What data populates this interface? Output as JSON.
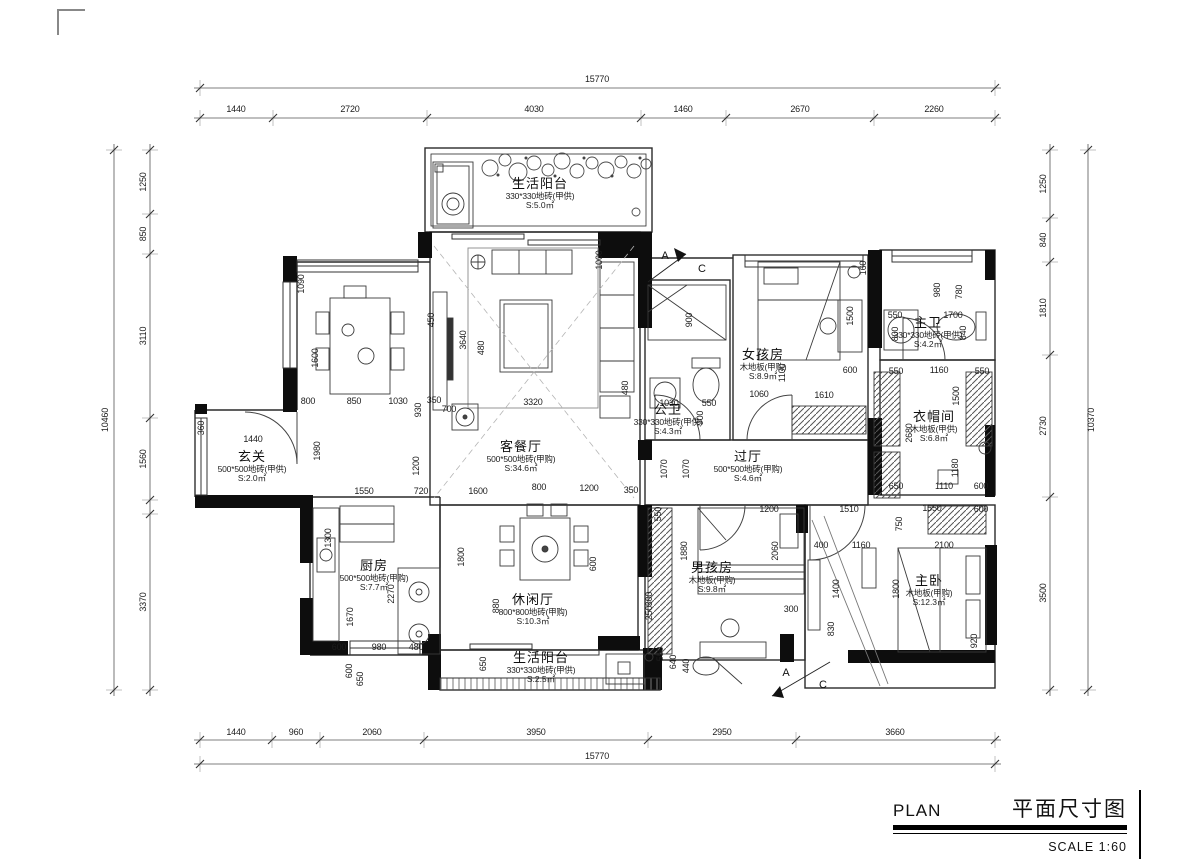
{
  "title_block": {
    "plan_en": "PLAN",
    "plan_zh": "平面尺寸图",
    "scale": "SCALE 1:60"
  },
  "plan": {
    "rooms": [
      {
        "name": "生活阳台",
        "spec": "330*330地砖(甲供)",
        "area": "S:5.0㎡",
        "x": 540,
        "y": 188
      },
      {
        "name": "玄关",
        "spec": "500*500地砖(甲供)",
        "area": "S:2.0㎡",
        "x": 252,
        "y": 461
      },
      {
        "name": "客餐厅",
        "spec": "500*500地砖(甲购)",
        "area": "S:34.6㎡",
        "x": 521,
        "y": 451
      },
      {
        "name": "公卫",
        "spec": "330*330地砖(甲供)",
        "area": "S:4.3㎡",
        "x": 668,
        "y": 414
      },
      {
        "name": "女孩房",
        "spec": "木地板(甲购)",
        "area": "S:8.9㎡",
        "x": 763,
        "y": 359
      },
      {
        "name": "主卫",
        "spec": "330*330地砖(甲供)",
        "area": "S:4.2㎡",
        "x": 928,
        "y": 327
      },
      {
        "name": "衣帽间",
        "spec": "木地板(甲供)",
        "area": "S:6.8㎡",
        "x": 934,
        "y": 421
      },
      {
        "name": "过厅",
        "spec": "500*500地砖(甲购)",
        "area": "S:4.6㎡",
        "x": 748,
        "y": 461
      },
      {
        "name": "厨房",
        "spec": "500*500地砖(甲购)",
        "area": "S:7.7㎡",
        "x": 374,
        "y": 570
      },
      {
        "name": "休闲厅",
        "spec": "800*800地砖(甲购)",
        "area": "S:10.3㎡",
        "x": 533,
        "y": 604
      },
      {
        "name": "男孩房",
        "spec": "木地板(甲购)",
        "area": "S:9.8㎡",
        "x": 712,
        "y": 572
      },
      {
        "name": "主卧",
        "spec": "木地板(甲购)",
        "area": "S:12.3㎡",
        "x": 929,
        "y": 585
      },
      {
        "name": "生活阳台",
        "spec": "330*330地砖(甲供)",
        "area": "S:2.5㎡",
        "x": 541,
        "y": 662
      }
    ],
    "dims": [
      {
        "t": "15770",
        "x": 597,
        "y": 82
      },
      {
        "t": "1440",
        "x": 236,
        "y": 112
      },
      {
        "t": "2720",
        "x": 350,
        "y": 112
      },
      {
        "t": "4030",
        "x": 534,
        "y": 112
      },
      {
        "t": "1460",
        "x": 683,
        "y": 112
      },
      {
        "t": "2670",
        "x": 800,
        "y": 112
      },
      {
        "t": "2260",
        "x": 934,
        "y": 112
      },
      {
        "t": "1440",
        "x": 236,
        "y": 735
      },
      {
        "t": "960",
        "x": 296,
        "y": 735
      },
      {
        "t": "2060",
        "x": 372,
        "y": 735
      },
      {
        "t": "3950",
        "x": 536,
        "y": 735
      },
      {
        "t": "2950",
        "x": 722,
        "y": 735
      },
      {
        "t": "3660",
        "x": 895,
        "y": 735
      },
      {
        "t": "15770",
        "x": 597,
        "y": 759
      },
      {
        "t": "10460",
        "x": 108,
        "y": 420,
        "r": 1
      },
      {
        "t": "1250",
        "x": 146,
        "y": 182,
        "r": 1
      },
      {
        "t": "850",
        "x": 146,
        "y": 234,
        "r": 1
      },
      {
        "t": "3110",
        "x": 146,
        "y": 336,
        "r": 1
      },
      {
        "t": "1560",
        "x": 146,
        "y": 459,
        "r": 1
      },
      {
        "t": "3370",
        "x": 146,
        "y": 602,
        "r": 1
      },
      {
        "t": "10370",
        "x": 1094,
        "y": 420,
        "r": 1
      },
      {
        "t": "1250",
        "x": 1046,
        "y": 184,
        "r": 1
      },
      {
        "t": "840",
        "x": 1046,
        "y": 240,
        "r": 1
      },
      {
        "t": "1810",
        "x": 1046,
        "y": 308,
        "r": 1
      },
      {
        "t": "2730",
        "x": 1046,
        "y": 426,
        "r": 1
      },
      {
        "t": "3500",
        "x": 1046,
        "y": 593,
        "r": 1
      },
      {
        "t": "1090",
        "x": 304,
        "y": 284,
        "r": 1
      },
      {
        "t": "1600",
        "x": 318,
        "y": 358,
        "r": 1
      },
      {
        "t": "450",
        "x": 434,
        "y": 320,
        "r": 1
      },
      {
        "t": "3640",
        "x": 466,
        "y": 340,
        "r": 1
      },
      {
        "t": "480",
        "x": 484,
        "y": 348,
        "r": 1
      },
      {
        "t": "1000",
        "x": 602,
        "y": 260,
        "r": 1
      },
      {
        "t": "900",
        "x": 692,
        "y": 320,
        "r": 1
      },
      {
        "t": "1500",
        "x": 853,
        "y": 316,
        "r": 1
      },
      {
        "t": "160",
        "x": 866,
        "y": 268,
        "r": 1
      },
      {
        "t": "980",
        "x": 940,
        "y": 290,
        "r": 1
      },
      {
        "t": "780",
        "x": 962,
        "y": 292,
        "r": 1
      },
      {
        "t": "550",
        "x": 895,
        "y": 318
      },
      {
        "t": "1700",
        "x": 953,
        "y": 318
      },
      {
        "t": "800",
        "x": 898,
        "y": 334,
        "r": 1
      },
      {
        "t": "840",
        "x": 966,
        "y": 333,
        "r": 1
      },
      {
        "t": "800",
        "x": 308,
        "y": 404
      },
      {
        "t": "850",
        "x": 354,
        "y": 404
      },
      {
        "t": "1030",
        "x": 398,
        "y": 404
      },
      {
        "t": "930",
        "x": 421,
        "y": 410,
        "r": 1
      },
      {
        "t": "350",
        "x": 434,
        "y": 403
      },
      {
        "t": "700",
        "x": 449,
        "y": 412
      },
      {
        "t": "3320",
        "x": 533,
        "y": 405
      },
      {
        "t": "1030",
        "x": 669,
        "y": 406
      },
      {
        "t": "550",
        "x": 709,
        "y": 406
      },
      {
        "t": "900",
        "x": 703,
        "y": 418,
        "r": 1
      },
      {
        "t": "1060",
        "x": 759,
        "y": 397
      },
      {
        "t": "1610",
        "x": 824,
        "y": 398
      },
      {
        "t": "1100",
        "x": 785,
        "y": 373,
        "r": 1
      },
      {
        "t": "600",
        "x": 850,
        "y": 373
      },
      {
        "t": "550",
        "x": 896,
        "y": 374
      },
      {
        "t": "1160",
        "x": 939,
        "y": 373
      },
      {
        "t": "550",
        "x": 982,
        "y": 374
      },
      {
        "t": "1500",
        "x": 959,
        "y": 396,
        "r": 1
      },
      {
        "t": "2680",
        "x": 912,
        "y": 433,
        "r": 1
      },
      {
        "t": "1180",
        "x": 958,
        "y": 468,
        "r": 1
      },
      {
        "t": "1980",
        "x": 320,
        "y": 451,
        "r": 1
      },
      {
        "t": "1200",
        "x": 419,
        "y": 466,
        "r": 1
      },
      {
        "t": "1070",
        "x": 667,
        "y": 469,
        "r": 1
      },
      {
        "t": "1070",
        "x": 689,
        "y": 469,
        "r": 1
      },
      {
        "t": "480",
        "x": 628,
        "y": 388,
        "r": 1
      },
      {
        "t": "360",
        "x": 204,
        "y": 428,
        "r": 1
      },
      {
        "t": "1440",
        "x": 253,
        "y": 442
      },
      {
        "t": "650",
        "x": 896,
        "y": 489
      },
      {
        "t": "1110",
        "x": 944,
        "y": 489
      },
      {
        "t": "600",
        "x": 981,
        "y": 489
      },
      {
        "t": "1550",
        "x": 364,
        "y": 494
      },
      {
        "t": "720",
        "x": 421,
        "y": 494
      },
      {
        "t": "1600",
        "x": 478,
        "y": 494
      },
      {
        "t": "800",
        "x": 539,
        "y": 490
      },
      {
        "t": "1200",
        "x": 589,
        "y": 491
      },
      {
        "t": "350",
        "x": 631,
        "y": 493
      },
      {
        "t": "1510",
        "x": 849,
        "y": 512
      },
      {
        "t": "1550",
        "x": 932,
        "y": 511
      },
      {
        "t": "600",
        "x": 981,
        "y": 512
      },
      {
        "t": "750",
        "x": 902,
        "y": 524,
        "r": 1
      },
      {
        "t": "400",
        "x": 821,
        "y": 548
      },
      {
        "t": "1160",
        "x": 861,
        "y": 548
      },
      {
        "t": "2100",
        "x": 944,
        "y": 548
      },
      {
        "t": "550",
        "x": 661,
        "y": 514,
        "r": 1
      },
      {
        "t": "1200",
        "x": 769,
        "y": 512
      },
      {
        "t": "1880",
        "x": 687,
        "y": 551,
        "r": 1
      },
      {
        "t": "2060",
        "x": 778,
        "y": 551,
        "r": 1
      },
      {
        "t": "300",
        "x": 791,
        "y": 612
      },
      {
        "t": "830",
        "x": 834,
        "y": 629,
        "r": 1
      },
      {
        "t": "300",
        "x": 652,
        "y": 599,
        "r": 1
      },
      {
        "t": "250",
        "x": 652,
        "y": 613,
        "r": 1
      },
      {
        "t": "1300",
        "x": 331,
        "y": 538,
        "r": 1
      },
      {
        "t": "1670",
        "x": 353,
        "y": 617,
        "r": 1
      },
      {
        "t": "2270",
        "x": 394,
        "y": 594,
        "r": 1
      },
      {
        "t": "1800",
        "x": 464,
        "y": 557,
        "r": 1
      },
      {
        "t": "880",
        "x": 499,
        "y": 606,
        "r": 1
      },
      {
        "t": "600",
        "x": 596,
        "y": 564,
        "r": 1
      },
      {
        "t": "600",
        "x": 339,
        "y": 650
      },
      {
        "t": "980",
        "x": 379,
        "y": 650
      },
      {
        "t": "480",
        "x": 416,
        "y": 650
      },
      {
        "t": "600",
        "x": 352,
        "y": 671,
        "r": 1
      },
      {
        "t": "650",
        "x": 363,
        "y": 679,
        "r": 1
      },
      {
        "t": "650",
        "x": 486,
        "y": 664,
        "r": 1
      },
      {
        "t": "550",
        "x": 663,
        "y": 654,
        "r": 1
      },
      {
        "t": "640",
        "x": 676,
        "y": 662,
        "r": 1
      },
      {
        "t": "440",
        "x": 689,
        "y": 666,
        "r": 1
      },
      {
        "t": "1400",
        "x": 839,
        "y": 589,
        "r": 1
      },
      {
        "t": "1800",
        "x": 899,
        "y": 589,
        "r": 1
      },
      {
        "t": "920",
        "x": 977,
        "y": 641,
        "r": 1
      }
    ],
    "sections": [
      {
        "t": "A",
        "x": 665,
        "y": 259
      },
      {
        "t": "C",
        "x": 702,
        "y": 272
      },
      {
        "t": "A",
        "x": 786,
        "y": 676
      },
      {
        "t": "C",
        "x": 823,
        "y": 688
      }
    ]
  }
}
